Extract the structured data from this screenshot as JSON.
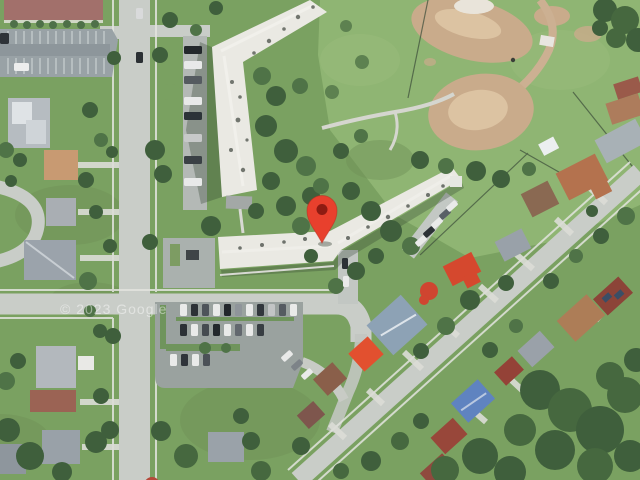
{
  "map": {
    "view_type": "satellite",
    "watermark": "© 2023 Google",
    "marker": {
      "label": "dropped-pin",
      "color": "#e8402d",
      "dot_color": "#8e1b12"
    }
  },
  "palette": {
    "grass": "#7aa161",
    "field_grass": "#8fb573",
    "tree_dark": "#3f5f3c",
    "tree_mid": "#4f7347",
    "road": "#c9cdc8",
    "sidewalk": "#e6e7e2",
    "asphalt": "#99a2a6",
    "building_roof": "#eae9e3",
    "maroon_roof": "#a2706b",
    "dirt": "#c9ab8b",
    "dirt_light": "#dcc3a2",
    "bright_red_roof": "#d5482e",
    "dark_red_roof": "#98473a",
    "blue_roof": "#5f83c0",
    "gray_roof": "#9aa1a9",
    "tan_roof": "#b07c55",
    "watermark_color": "#ffffff"
  }
}
